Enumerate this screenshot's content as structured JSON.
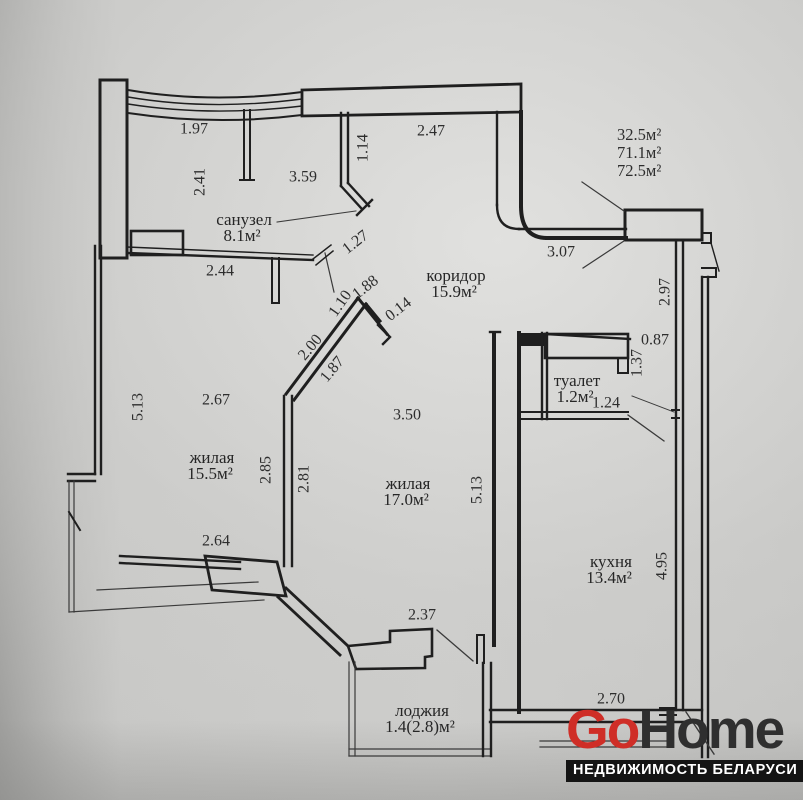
{
  "photo": {
    "wall_color": "#1f1f1f",
    "thin_color": "#3a3a3a",
    "text_color": "#2d2d2d"
  },
  "summary_areas": {
    "items": [
      "32.5м²",
      "71.1м²",
      "72.5м²"
    ]
  },
  "rooms": [
    {
      "name": "санузел",
      "area": "8.1м²",
      "x": 244,
      "y": 221
    },
    {
      "name": "коридор",
      "area": "15.9м²",
      "x": 456,
      "y": 277
    },
    {
      "name": "жилая",
      "area": "15.5м²",
      "x": 212,
      "y": 459
    },
    {
      "name": "жилая",
      "area": "17.0м²",
      "x": 408,
      "y": 485
    },
    {
      "name": "туалет",
      "area": "1.2м²",
      "x": 577,
      "y": 382
    },
    {
      "name": "кухня",
      "area": "13.4м²",
      "x": 611,
      "y": 563
    },
    {
      "name": "лоджия",
      "area": "1.4(2.8)м²",
      "x": 422,
      "y": 712
    }
  ],
  "dimensions": [
    {
      "v": "1.97",
      "x": 194,
      "y": 130,
      "r": 0
    },
    {
      "v": "2.41",
      "x": 201,
      "y": 182,
      "r": -90
    },
    {
      "v": "3.59",
      "x": 303,
      "y": 178,
      "r": 0
    },
    {
      "v": "1.14",
      "x": 364,
      "y": 148,
      "r": -90
    },
    {
      "v": "2.47",
      "x": 431,
      "y": 132,
      "r": 0
    },
    {
      "v": "1.27",
      "x": 356,
      "y": 243,
      "r": -38
    },
    {
      "v": "2.44",
      "x": 220,
      "y": 272,
      "r": 0
    },
    {
      "v": "1.88",
      "x": 366,
      "y": 288,
      "r": -38
    },
    {
      "v": "1.10",
      "x": 341,
      "y": 304,
      "r": -55
    },
    {
      "v": "0.14",
      "x": 399,
      "y": 310,
      "r": -38
    },
    {
      "v": "2.00",
      "x": 311,
      "y": 348,
      "r": -50
    },
    {
      "v": "1.87",
      "x": 333,
      "y": 370,
      "r": -50
    },
    {
      "v": "3.07",
      "x": 561,
      "y": 253,
      "r": 0
    },
    {
      "v": "2.97",
      "x": 666,
      "y": 292,
      "r": -90
    },
    {
      "v": "0.87",
      "x": 655,
      "y": 341,
      "r": 0
    },
    {
      "v": "1.37",
      "x": 638,
      "y": 363,
      "r": -90
    },
    {
      "v": "1.24",
      "x": 606,
      "y": 404,
      "r": 0
    },
    {
      "v": "5.13",
      "x": 139,
      "y": 407,
      "r": -90
    },
    {
      "v": "2.67",
      "x": 216,
      "y": 401,
      "r": 0
    },
    {
      "v": "2.85",
      "x": 267,
      "y": 470,
      "r": -90
    },
    {
      "v": "2.81",
      "x": 305,
      "y": 479,
      "r": -90
    },
    {
      "v": "3.50",
      "x": 407,
      "y": 416,
      "r": 0
    },
    {
      "v": "5.13",
      "x": 478,
      "y": 490,
      "r": -90
    },
    {
      "v": "4.95",
      "x": 663,
      "y": 566,
      "r": -90
    },
    {
      "v": "2.64",
      "x": 216,
      "y": 542,
      "r": 0
    },
    {
      "v": "2.37",
      "x": 422,
      "y": 616,
      "r": 0
    },
    {
      "v": "2.70",
      "x": 611,
      "y": 700,
      "r": 0
    }
  ],
  "logo": {
    "go": "Go",
    "home": "Home",
    "tagline": "НЕДВИЖИМОСТЬ БЕЛАРУСИ",
    "go_color": "#cf2e27",
    "home_color": "#2f2f2f",
    "bar_color": "#141414",
    "tagline_color": "#ffffff"
  }
}
